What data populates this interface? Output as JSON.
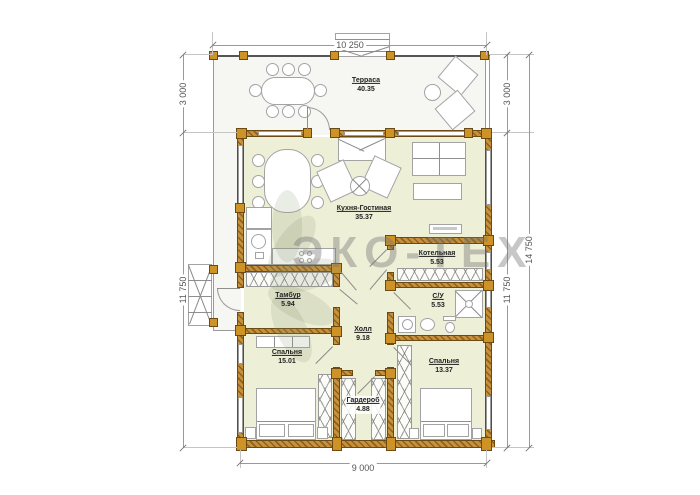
{
  "watermark": {
    "text": "ЭКО-ТЕХ"
  },
  "dimensions": {
    "top": "10 250",
    "left_upper": "3 000",
    "left_lower": "11 750",
    "right_upper": "3 000",
    "right_lower": "11 750",
    "right_total": "14 750",
    "bottom": "9 000"
  },
  "rooms": [
    {
      "id": "terrace",
      "name": "Терраса",
      "area": "40.35"
    },
    {
      "id": "living",
      "name": "Кухня-Гостиная",
      "area": "35.37"
    },
    {
      "id": "boiler",
      "name": "Котельная",
      "area": "5.53"
    },
    {
      "id": "tambour",
      "name": "Тамбур",
      "area": "5.94"
    },
    {
      "id": "hall",
      "name": "Холл",
      "area": "9.18"
    },
    {
      "id": "wc",
      "name": "С/У",
      "area": "5.53"
    },
    {
      "id": "bedroom1",
      "name": "Спальня",
      "area": "15.01"
    },
    {
      "id": "wardrobe",
      "name": "Гардероб",
      "area": "4.88"
    },
    {
      "id": "bedroom2",
      "name": "Спальня",
      "area": "13.37"
    }
  ]
}
